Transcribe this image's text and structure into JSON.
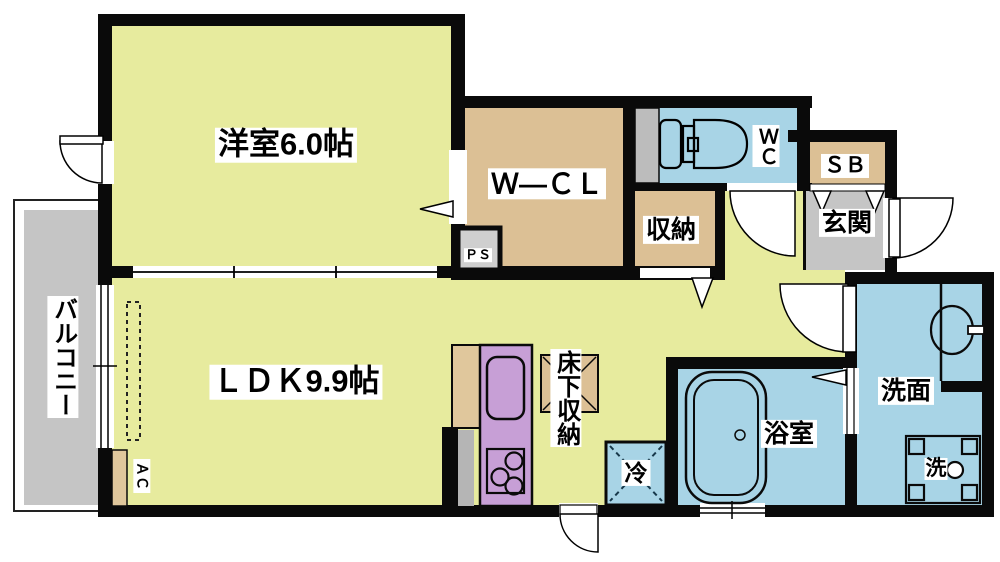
{
  "rooms": {
    "western_room": {
      "label": "洋室6.0帖"
    },
    "ldk": {
      "label": "ＬＤＫ9.9帖"
    },
    "walk_in_closet": {
      "label": "Ｗ—ＣＬ"
    },
    "wc": {
      "label": "ＷＣ"
    },
    "shoe_box": {
      "label": "ＳＢ"
    },
    "entrance": {
      "label": "玄関"
    },
    "storage": {
      "label": "収納"
    },
    "pipe_space": {
      "label": "ＰＳ"
    },
    "balcony": {
      "label": "バルコニー"
    },
    "air_conditioner": {
      "label": "ＡＣ"
    },
    "underfloor_storage": {
      "label": "床下収納"
    },
    "refrigerator": {
      "label": "冷"
    },
    "bathroom": {
      "label": "浴室"
    },
    "washroom": {
      "label": "洗面"
    },
    "washing_machine": {
      "label": "洗"
    }
  },
  "colors": {
    "wall": "#0a0a0a",
    "room_yellow": "#e7eb9e",
    "room_tan": "#dcc095",
    "room_blue": "#a8d4e6",
    "room_gray": "#c5c5c5",
    "duct_gray": "#bcbcbc",
    "kitchen_purple": "#c79fd6"
  }
}
